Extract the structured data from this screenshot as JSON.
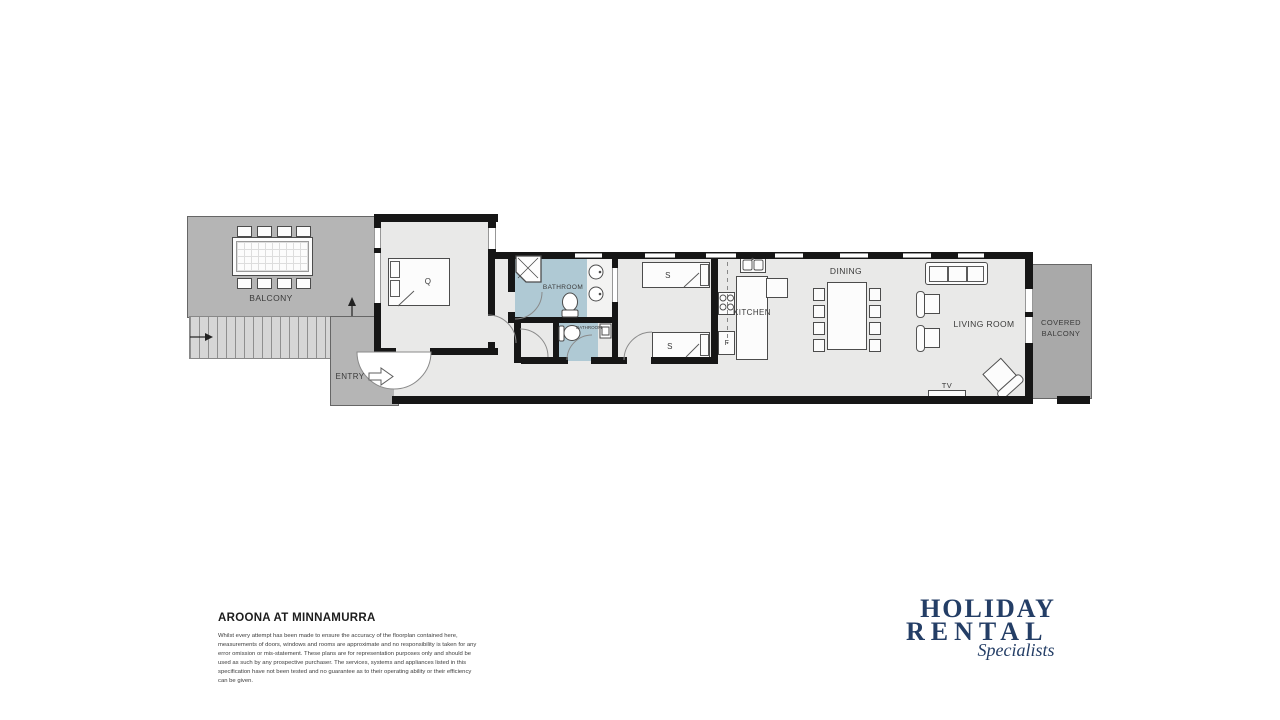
{
  "floorplan": {
    "labels": {
      "balcony": "BALCONY",
      "entry": "ENTRY",
      "queen_bed": "Q",
      "bathroom_main": "BATHROOM",
      "bathroom_small": "BATHROOM",
      "single_bed": "S",
      "kitchen": "KITCHEN",
      "fridge": "F",
      "dining": "DINING",
      "living_room": "LIVING ROOM",
      "tv": "TV",
      "covered_line1": "COVERED",
      "covered_line2": "BALCONY"
    }
  },
  "footer": {
    "property_title": "AROONA AT MINNAMURRA",
    "disclaimer": "Whilst every attempt has been made to ensure the accuracy of the floorplan contained here, measurements of doors, windows and rooms are approximate and no responsibility is taken for any error omission or mis-statement. These plans are for representation purposes only and should be used as such by any prospective purchaser. The services, systems and appliances listed in this specification have not been tested and no guarantee as to their operating ability or their efficiency can be given."
  },
  "logo": {
    "line1": "HOLIDAY",
    "line2": "RENTAL",
    "tagline": "Specialists"
  },
  "colors": {
    "wall": "#161616",
    "floor": "#e9e9e8",
    "bath": "#afc9d4",
    "balcony": "#b5b5b5",
    "stairs": "#d6d6d6",
    "covered": "#a9a9a9",
    "navy": "#243e66"
  }
}
